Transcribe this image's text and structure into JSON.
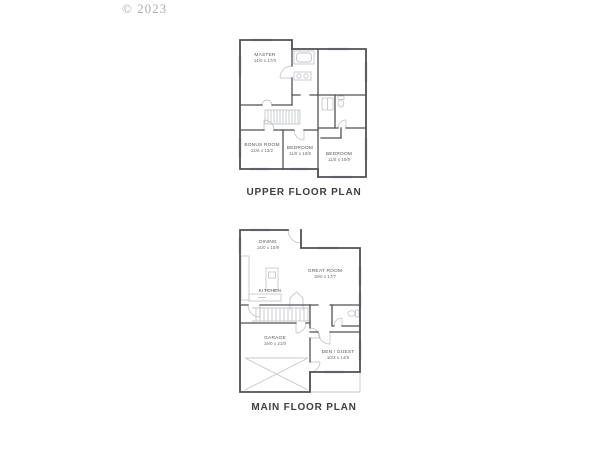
{
  "watermark": "© 2023",
  "colors": {
    "background": "#ffffff",
    "wall": "#505156",
    "detail": "#c4c7cb",
    "window": "#ced1d5",
    "label": "#55565b",
    "caption": "#3d3e42",
    "watermark": "#a9aeb6"
  },
  "upper_plan": {
    "caption": "UPPER FLOOR PLAN",
    "rooms": {
      "master": {
        "name": "MASTER",
        "dims": "14/0 x 17/0"
      },
      "bonus": {
        "name": "BONUS ROOM",
        "dims": "12/6 x 13/2"
      },
      "bedroom2": {
        "name": "BEDROOM",
        "dims": "11/0 x 10/9"
      },
      "bedroom3": {
        "name": "BEDROOM",
        "dims": "11/0 x 10/9"
      }
    }
  },
  "main_plan": {
    "caption": "MAIN FLOOR PLAN",
    "rooms": {
      "dining": {
        "name": "DINING",
        "dims": "14/0 x 10/9"
      },
      "great_room": {
        "name": "GREAT ROOM",
        "dims": "19/0 x 17/7"
      },
      "kitchen": {
        "name": "KITCHEN"
      },
      "garage": {
        "name": "GARAGE",
        "dims": "19/0 x 21/0"
      },
      "den_guest": {
        "name": "DEN / GUEST",
        "dims": "10/3 x 14/5"
      }
    }
  }
}
